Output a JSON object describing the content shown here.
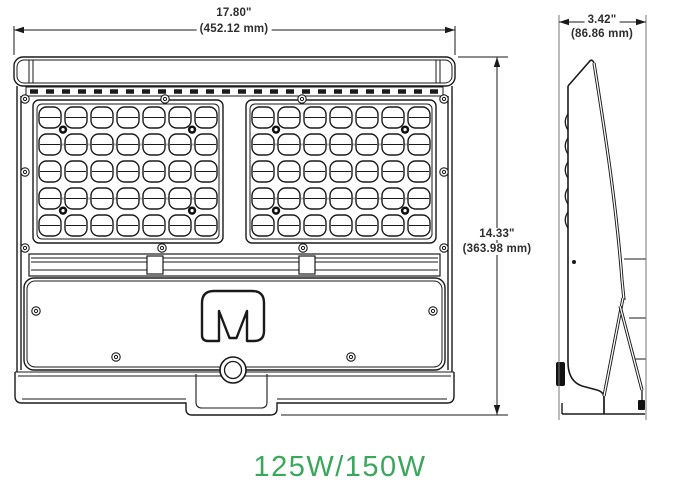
{
  "drawing": {
    "dimension_width": {
      "inches": "17.80\"",
      "mm": "(452.12 mm)"
    },
    "dimension_height": {
      "inches": "14.33\"",
      "mm": "(363.98 mm)"
    },
    "dimension_depth": {
      "inches": "3.42\"",
      "mm": "(86.86 mm)"
    },
    "logo_letter": "M",
    "led_panels": {
      "count": 2,
      "columns": 7,
      "rows": 5
    },
    "colors": {
      "line": "#1a1a1a",
      "dim_text": "#2e2e2e",
      "accent_green": "#3aa85c"
    }
  },
  "label": {
    "wattage": "125W/150W"
  }
}
